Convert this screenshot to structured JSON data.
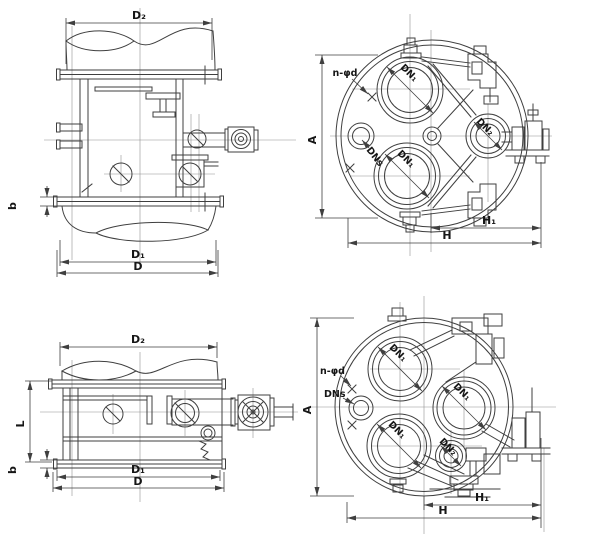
{
  "colors": {
    "background": "#ffffff",
    "line": "#3f3f3f",
    "centerline": "#8f8f8f",
    "text": "#161616"
  },
  "labels": {
    "d2": "D₂",
    "d1": "D₁",
    "d": "D",
    "b": "b",
    "l": "L",
    "a": "A",
    "h": "H",
    "h1": "H₁",
    "dn1": "DN₁",
    "dn2": "DN₂",
    "dns": "DNs",
    "bolt_pattern": "n-φd"
  },
  "views": {
    "top_elevation": {
      "dimension_labels": [
        "D₂",
        "b",
        "D₁",
        "D"
      ]
    },
    "top_plan": {
      "dimension_labels": [
        "n-φd",
        "A",
        "DN₁",
        "DNs",
        "DN₂",
        "H₁",
        "H"
      ]
    },
    "bottom_elevation": {
      "dimension_labels": [
        "D₂",
        "L",
        "b",
        "D₁",
        "D"
      ]
    },
    "bottom_plan": {
      "dimension_labels": [
        "n-φd",
        "DNs",
        "A",
        "DN₁",
        "DN₂",
        "H₁",
        "H"
      ]
    }
  }
}
